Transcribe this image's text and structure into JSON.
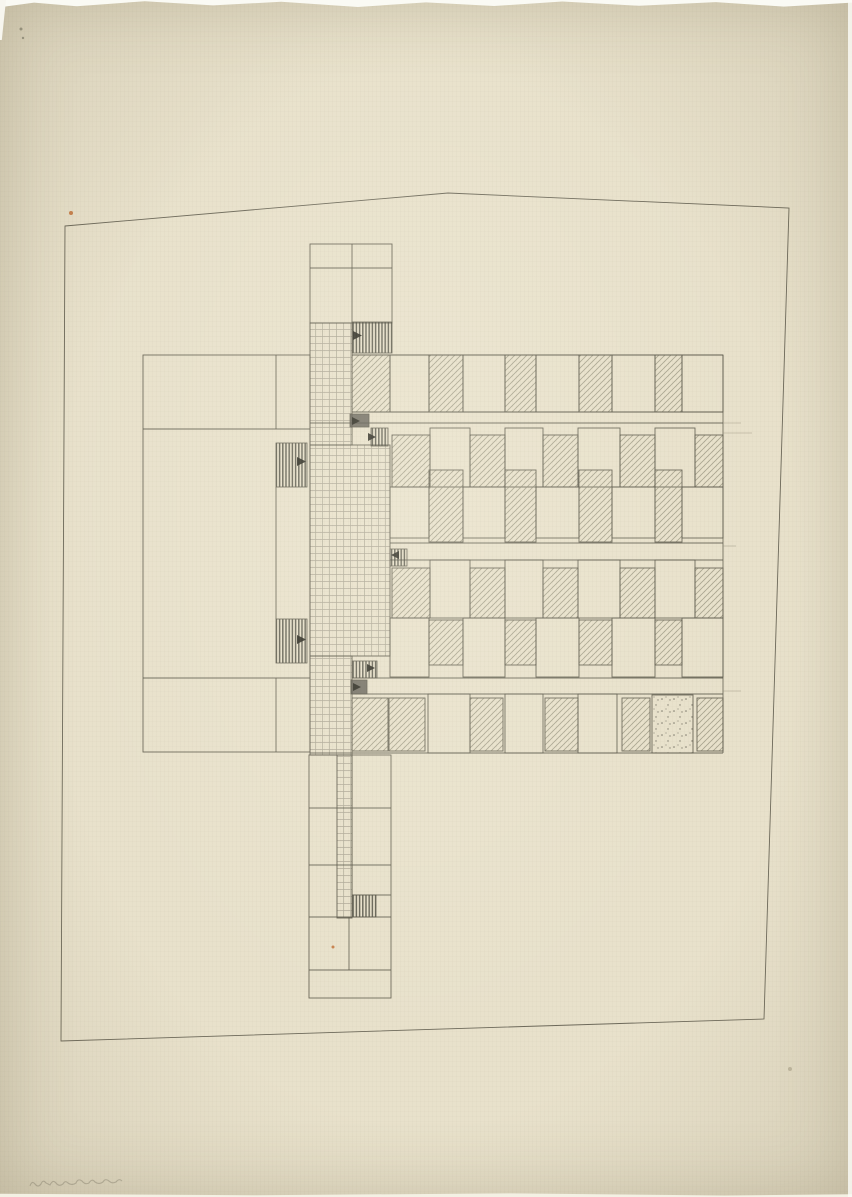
{
  "document": {
    "kind": "architectural floor plan sketch, pencil and ink on aged tracing paper",
    "visible_text": "none (only an illegible faint pencil inscription at bottom left)"
  },
  "palette": {
    "paper": "#e8e1cb",
    "line_main": "#5b584a",
    "line_faint": "#97927e",
    "pencil_hatch": "#8b8673",
    "stripe_dark": "#3f3e33",
    "block_dark": "#56534a",
    "triangle": "#29281f",
    "speck_orange": "#c06a2e"
  },
  "canvas": {
    "width": 852,
    "height": 1197
  },
  "site_boundary": {
    "points": [
      [
        65,
        226
      ],
      [
        448,
        193
      ],
      [
        789,
        208
      ],
      [
        764,
        1019
      ],
      [
        61,
        1041
      ]
    ]
  },
  "plan": {
    "outline_rects": [
      {
        "x": 310,
        "y": 244,
        "w": 82,
        "h": 79,
        "name": "top-block"
      },
      {
        "x": 143,
        "y": 355,
        "w": 167,
        "h": 397,
        "name": "left-wing"
      },
      {
        "x": 309,
        "y": 755,
        "w": 82,
        "h": 243,
        "name": "south-tail"
      }
    ],
    "grid_rects": [
      {
        "x": 310,
        "y": 323,
        "w": 42,
        "h": 122,
        "name": "spine-grid-upper"
      },
      {
        "x": 310,
        "y": 445,
        "w": 80,
        "h": 211,
        "name": "spine-grid-middle"
      },
      {
        "x": 310,
        "y": 656,
        "w": 42,
        "h": 99,
        "name": "spine-grid-lower"
      },
      {
        "x": 337,
        "y": 755,
        "w": 15,
        "h": 163,
        "name": "tail-ladder"
      }
    ],
    "lines_main": [
      {
        "x1": 310,
        "y1": 268,
        "x2": 392,
        "y2": 268
      },
      {
        "x1": 352,
        "y1": 244,
        "x2": 352,
        "y2": 323
      },
      {
        "x1": 143,
        "y1": 429,
        "x2": 310,
        "y2": 429
      },
      {
        "x1": 143,
        "y1": 678,
        "x2": 310,
        "y2": 678
      },
      {
        "x1": 276,
        "y1": 355,
        "x2": 276,
        "y2": 429
      },
      {
        "x1": 276,
        "y1": 487,
        "x2": 276,
        "y2": 619
      },
      {
        "x1": 276,
        "y1": 678,
        "x2": 276,
        "y2": 752
      },
      {
        "x1": 352,
        "y1": 355,
        "x2": 723,
        "y2": 355
      },
      {
        "x1": 723,
        "y1": 355,
        "x2": 723,
        "y2": 753
      },
      {
        "x1": 310,
        "y1": 753,
        "x2": 723,
        "y2": 753
      },
      {
        "x1": 352,
        "y1": 412,
        "x2": 723,
        "y2": 412
      },
      {
        "x1": 310,
        "y1": 423,
        "x2": 723,
        "y2": 423
      },
      {
        "x1": 390,
        "y1": 543,
        "x2": 723,
        "y2": 543
      },
      {
        "x1": 390,
        "y1": 560,
        "x2": 723,
        "y2": 560
      },
      {
        "x1": 352,
        "y1": 678,
        "x2": 723,
        "y2": 678
      },
      {
        "x1": 352,
        "y1": 694,
        "x2": 723,
        "y2": 694
      },
      {
        "x1": 309,
        "y1": 808,
        "x2": 391,
        "y2": 808
      },
      {
        "x1": 309,
        "y1": 865,
        "x2": 391,
        "y2": 865
      },
      {
        "x1": 352,
        "y1": 895,
        "x2": 391,
        "y2": 895
      },
      {
        "x1": 309,
        "y1": 917,
        "x2": 391,
        "y2": 917
      },
      {
        "x1": 309,
        "y1": 970,
        "x2": 391,
        "y2": 970
      },
      {
        "x1": 352,
        "y1": 755,
        "x2": 352,
        "y2": 917
      },
      {
        "x1": 349,
        "y1": 917,
        "x2": 349,
        "y2": 970
      }
    ],
    "lines_faint": [
      {
        "x1": 723,
        "y1": 423,
        "x2": 741,
        "y2": 423
      },
      {
        "x1": 723,
        "y1": 433,
        "x2": 752,
        "y2": 433
      },
      {
        "x1": 723,
        "y1": 546,
        "x2": 736,
        "y2": 546
      },
      {
        "x1": 723,
        "y1": 691,
        "x2": 741,
        "y2": 691
      }
    ],
    "room_rows": [
      {
        "name": "row-1",
        "y": 355,
        "h": 57,
        "rooms": [
          {
            "x": 352,
            "w": 38,
            "f": "h"
          },
          {
            "x": 390,
            "w": 39,
            "f": "p"
          },
          {
            "x": 429,
            "w": 34,
            "f": "h"
          },
          {
            "x": 463,
            "w": 42,
            "f": "p"
          },
          {
            "x": 505,
            "w": 31,
            "f": "h"
          },
          {
            "x": 536,
            "w": 43,
            "f": "p"
          },
          {
            "x": 579,
            "w": 33,
            "f": "h"
          },
          {
            "x": 612,
            "w": 43,
            "f": "p"
          },
          {
            "x": 655,
            "w": 27,
            "f": "h"
          },
          {
            "x": 682,
            "w": 41,
            "f": "p"
          }
        ]
      },
      {
        "name": "row-2",
        "y": 428,
        "h": 59,
        "rooms": [
          {
            "x": 392,
            "w": 38,
            "f": "h",
            "dy": 7,
            "dh": -7
          },
          {
            "x": 430,
            "w": 40,
            "f": "p"
          },
          {
            "x": 470,
            "w": 35,
            "f": "h",
            "dy": 7,
            "dh": -7
          },
          {
            "x": 505,
            "w": 38,
            "f": "p"
          },
          {
            "x": 543,
            "w": 35,
            "f": "h",
            "dy": 7,
            "dh": -7
          },
          {
            "x": 578,
            "w": 42,
            "f": "p"
          },
          {
            "x": 620,
            "w": 35,
            "f": "h",
            "dy": 7,
            "dh": -7
          },
          {
            "x": 655,
            "w": 40,
            "f": "p"
          },
          {
            "x": 695,
            "w": 28,
            "f": "h",
            "dy": 7,
            "dh": -7
          }
        ]
      },
      {
        "name": "row-3",
        "y": 487,
        "h": 56,
        "rooms": [
          {
            "x": 390,
            "w": 39,
            "f": "p",
            "dh": -5
          },
          {
            "x": 429,
            "w": 34,
            "f": "h",
            "dy": -17,
            "dh": 16
          },
          {
            "x": 463,
            "w": 42,
            "f": "p",
            "dh": -5
          },
          {
            "x": 505,
            "w": 31,
            "f": "h",
            "dy": -17,
            "dh": 16
          },
          {
            "x": 536,
            "w": 43,
            "f": "p",
            "dh": -5
          },
          {
            "x": 579,
            "w": 33,
            "f": "h",
            "dy": -17,
            "dh": 16
          },
          {
            "x": 612,
            "w": 43,
            "f": "p",
            "dh": -5
          },
          {
            "x": 655,
            "w": 27,
            "f": "h",
            "dy": -17,
            "dh": 16
          },
          {
            "x": 682,
            "w": 41,
            "f": "p",
            "dh": -5
          }
        ]
      },
      {
        "name": "row-4",
        "y": 560,
        "h": 58,
        "rooms": [
          {
            "x": 392,
            "w": 38,
            "f": "h",
            "dy": 8,
            "dh": -8
          },
          {
            "x": 430,
            "w": 40,
            "f": "p"
          },
          {
            "x": 470,
            "w": 35,
            "f": "h",
            "dy": 8,
            "dh": -8
          },
          {
            "x": 505,
            "w": 38,
            "f": "p"
          },
          {
            "x": 543,
            "w": 35,
            "f": "h",
            "dy": 8,
            "dh": -8
          },
          {
            "x": 578,
            "w": 42,
            "f": "p"
          },
          {
            "x": 620,
            "w": 35,
            "f": "h",
            "dy": 8,
            "dh": -8
          },
          {
            "x": 655,
            "w": 40,
            "f": "p"
          },
          {
            "x": 695,
            "w": 28,
            "f": "h",
            "dy": 8,
            "dh": -8
          }
        ]
      },
      {
        "name": "row-5",
        "y": 618,
        "h": 59,
        "rooms": [
          {
            "x": 390,
            "w": 39,
            "f": "p"
          },
          {
            "x": 429,
            "w": 34,
            "f": "h",
            "dy": 2,
            "dh": -14
          },
          {
            "x": 463,
            "w": 42,
            "f": "p"
          },
          {
            "x": 505,
            "w": 31,
            "f": "h",
            "dy": 2,
            "dh": -14
          },
          {
            "x": 536,
            "w": 43,
            "f": "p"
          },
          {
            "x": 579,
            "w": 33,
            "f": "h",
            "dy": 2,
            "dh": -14
          },
          {
            "x": 612,
            "w": 43,
            "f": "p"
          },
          {
            "x": 655,
            "w": 27,
            "f": "h",
            "dy": 2,
            "dh": -14
          },
          {
            "x": 682,
            "w": 41,
            "f": "p"
          }
        ]
      },
      {
        "name": "row-6",
        "y": 695,
        "h": 58,
        "rooms": [
          {
            "x": 352,
            "w": 36,
            "f": "h",
            "dy": 3,
            "dh": -5
          },
          {
            "x": 389,
            "w": 36,
            "f": "h",
            "dy": 3,
            "dh": -5
          },
          {
            "x": 428,
            "w": 42,
            "f": "p",
            "dy": -1,
            "dh": 1
          },
          {
            "x": 470,
            "w": 33,
            "f": "h",
            "dy": 3,
            "dh": -5
          },
          {
            "x": 505,
            "w": 38,
            "f": "p",
            "dy": -1,
            "dh": 1
          },
          {
            "x": 545,
            "w": 33,
            "f": "h",
            "dy": 3,
            "dh": -5
          },
          {
            "x": 578,
            "w": 39,
            "f": "p",
            "dy": -1,
            "dh": 1
          },
          {
            "x": 622,
            "w": 28,
            "f": "h",
            "dy": 3,
            "dh": -5
          },
          {
            "x": 652,
            "w": 41,
            "f": "s"
          },
          {
            "x": 697,
            "w": 26,
            "f": "h",
            "dy": 3,
            "dh": -5
          }
        ]
      }
    ],
    "blocks": [
      {
        "x": 352,
        "y": 322,
        "w": 40,
        "h": 31,
        "t": "stripe",
        "name": "junction-top"
      },
      {
        "x": 350,
        "y": 414,
        "w": 19,
        "h": 13,
        "t": "dark",
        "name": "junction-2-dark"
      },
      {
        "x": 371,
        "y": 428,
        "w": 17,
        "h": 18,
        "t": "stripe",
        "name": "junction-2-stripe"
      },
      {
        "x": 390,
        "y": 549,
        "w": 17,
        "h": 17,
        "t": "stripe",
        "name": "junction-mid"
      },
      {
        "x": 352,
        "y": 661,
        "w": 25,
        "h": 17,
        "t": "stripe",
        "name": "junction-3-stripe"
      },
      {
        "x": 351,
        "y": 680,
        "w": 16,
        "h": 14,
        "t": "dark",
        "name": "junction-3-dark"
      },
      {
        "x": 352,
        "y": 895,
        "w": 24,
        "h": 22,
        "t": "stripe",
        "name": "tail-stripe"
      },
      {
        "x": 276,
        "y": 443,
        "w": 31,
        "h": 44,
        "t": "stripe",
        "name": "left-wing-stripe-upper"
      },
      {
        "x": 276,
        "y": 619,
        "w": 31,
        "h": 44,
        "t": "stripe",
        "name": "left-wing-stripe-lower"
      }
    ],
    "triangles": [
      {
        "x": 353,
        "y": 331,
        "s": 9,
        "dir": "right"
      },
      {
        "x": 352,
        "y": 417,
        "s": 8,
        "dir": "right"
      },
      {
        "x": 368,
        "y": 433,
        "s": 8,
        "dir": "right"
      },
      {
        "x": 391,
        "y": 551,
        "s": 8,
        "dir": "left"
      },
      {
        "x": 367,
        "y": 664,
        "s": 8,
        "dir": "right"
      },
      {
        "x": 353,
        "y": 683,
        "s": 8,
        "dir": "right"
      },
      {
        "x": 297,
        "y": 457,
        "s": 9,
        "dir": "right"
      },
      {
        "x": 297,
        "y": 635,
        "s": 9,
        "dir": "right"
      }
    ],
    "specks": [
      {
        "x": 71,
        "y": 213,
        "r": 2,
        "c": "#c06a2e"
      },
      {
        "x": 333,
        "y": 947,
        "r": 1.5,
        "c": "#c06a2e"
      },
      {
        "x": 21,
        "y": 29,
        "r": 1.5,
        "c": "#8a8878"
      },
      {
        "x": 23,
        "y": 38,
        "r": 1.2,
        "c": "#8a8878"
      },
      {
        "x": 790,
        "y": 1069,
        "r": 2,
        "c": "#b8b09a"
      }
    ]
  },
  "annotations": {
    "handwritten_note": {
      "description": "illegible faint pencil inscription",
      "x": 30,
      "y": 1176,
      "w": 88,
      "path": "M0,10 q2,-6 5,-2 q3,4 6,0 q2,-5 5,-1 l4,2 q3,-6 6,-2 q3,4 7,1 q2,-4 5,-1 q4,3 8,0 q2,-5 6,-2 q3,4 7,2 q3,-5 6,-1 q4,3 8,0 q2,-4 6,-1 q3,3 7,1 q3,-4 6,-1"
    }
  }
}
